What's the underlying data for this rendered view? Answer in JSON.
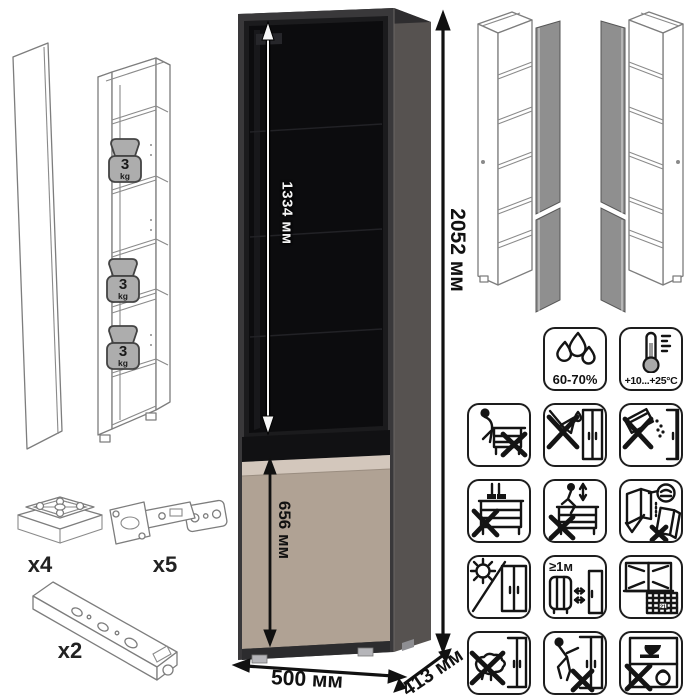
{
  "dimensions": {
    "glass_door_height": "1334 мм",
    "total_height": "2052 мм",
    "bottom_door_height": "656 мм",
    "width": "500 мм",
    "depth": "413 мм"
  },
  "shelf_load": {
    "value": "3",
    "unit": "kg"
  },
  "hardware": {
    "foot_glide_count": "x4",
    "hinge_count": "x5",
    "connecting_rail_count": "x2"
  },
  "climate": {
    "humidity_range": "60-70%",
    "temperature_range": "+10...+25°C"
  },
  "spacing": {
    "min_heater_distance": "≥1м"
  },
  "calendar": {
    "day": "21"
  },
  "colors": {
    "carcass_front": "#39383a",
    "carcass_side": "#565250",
    "glass": "#0c0c0e",
    "door_beige": "#b0a294",
    "door_beige_light": "#d3c7bc",
    "wireframe_line": "#7d7d7d",
    "open_door_gray": "#8f8f8f"
  },
  "icons": [
    {
      "name": "humidity-drops-icon"
    },
    {
      "name": "temperature-thermometer-icon"
    },
    {
      "name": "no-sitting-icon"
    },
    {
      "name": "no-scraping-icon"
    },
    {
      "name": "no-abrasive-powder-icon"
    },
    {
      "name": "no-standing-icon"
    },
    {
      "name": "no-jumping-icon"
    },
    {
      "name": "door-adjustment-icon"
    },
    {
      "name": "no-direct-sunlight-icon"
    },
    {
      "name": "min-distance-from-heater-icon"
    },
    {
      "name": "ventilation-period-icon"
    },
    {
      "name": "no-wet-cleaning-icon"
    },
    {
      "name": "no-dragging-icon"
    },
    {
      "name": "no-overloading-icon"
    }
  ]
}
